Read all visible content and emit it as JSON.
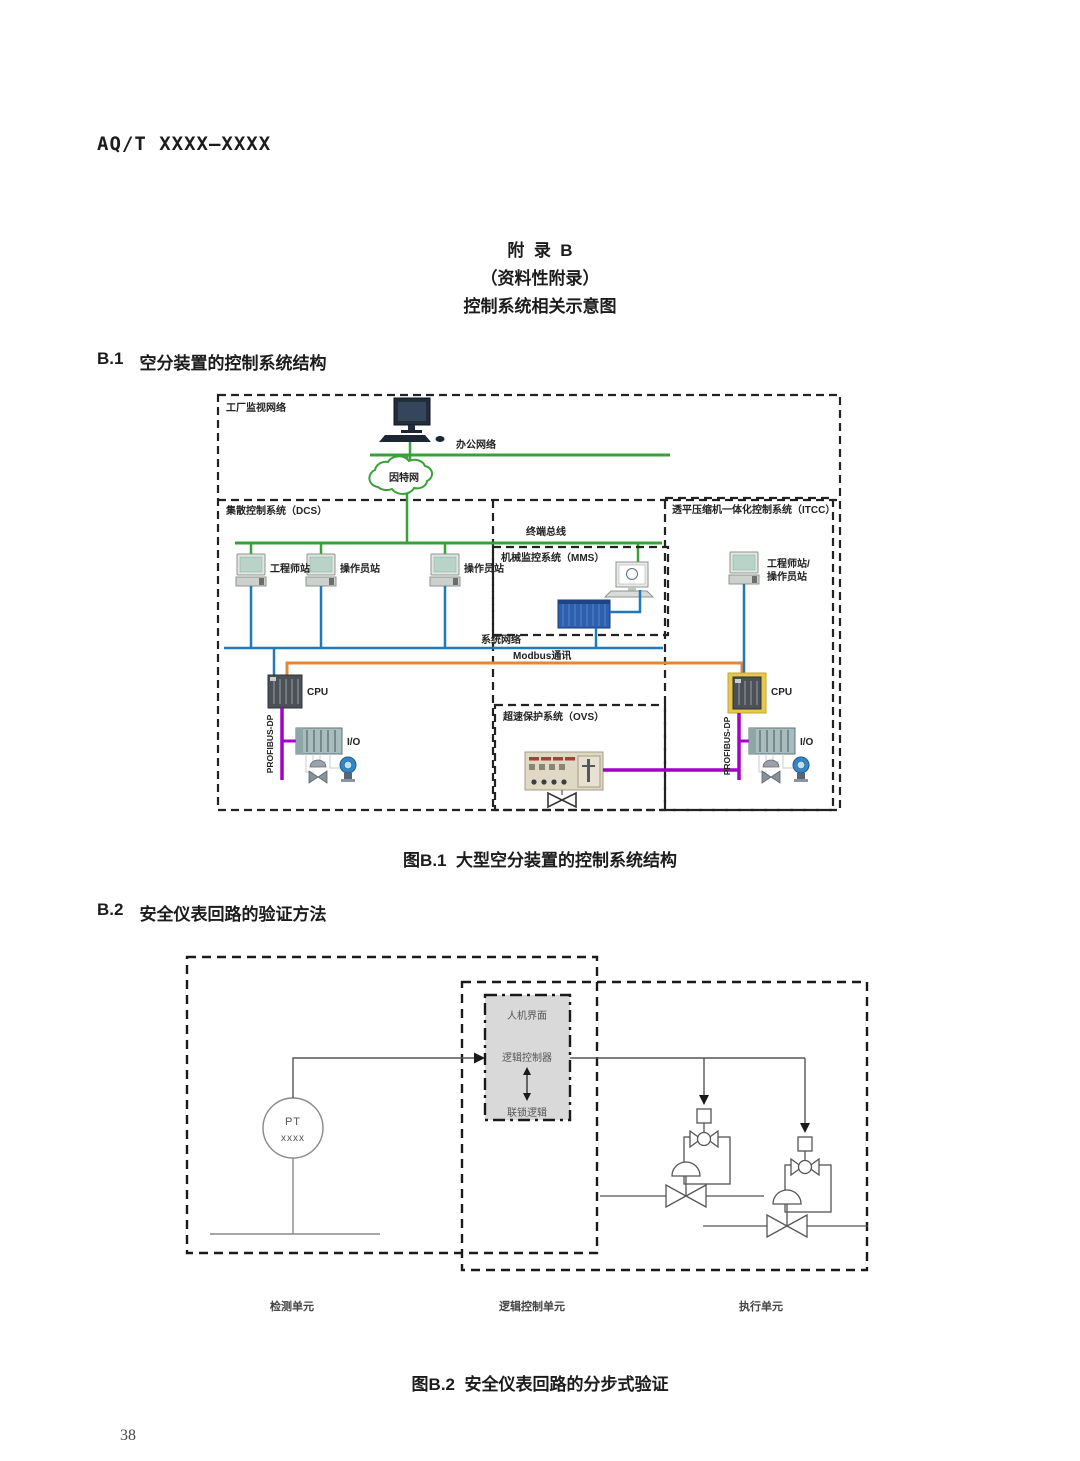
{
  "page": {
    "header": "AQ/T XXXX—XXXX",
    "number": "38"
  },
  "appendix": {
    "label": "附  录  B",
    "type": "（资料性附录）",
    "subject": "控制系统相关示意图"
  },
  "sections": {
    "b1": {
      "no": "B.1",
      "title": "空分装置的控制系统结构",
      "caption": "图B.1  大型空分装置的控制系统结构"
    },
    "b2": {
      "no": "B.2",
      "title": "安全仪表回路的验证方法",
      "caption": "图B.2  安全仪表回路的分步式验证"
    }
  },
  "fig_b1": {
    "plant_network": "工厂监视网络",
    "office_network": "办公网络",
    "internet": "因特网",
    "dcs": "集散控制系统（DCS）",
    "itcc": "透平压缩机一体化控制系统（ITCC）",
    "terminal_bus": "终端总线",
    "mms": "机械监控系统（MMS）",
    "ws_engineer": "工程师站",
    "ws_operator1": "操作员站",
    "ws_operator2": "操作员站",
    "itcc_ws_line1": "工程师站/",
    "itcc_ws_line2": "操作员站",
    "system_network": "系统网络",
    "modbus": "Modbus通讯",
    "cpu_left": "CPU",
    "cpu_right": "CPU",
    "profibus_left": "PROFIBUS-DP",
    "profibus_right": "PROFIBUS-DP",
    "io_left": "I/O",
    "io_right": "I/O",
    "ovs": "超速保护系统（OVS）",
    "colors": {
      "network_green": "#3aa13a",
      "system_blue": "#1f7ab5",
      "modbus_orange": "#e0873c",
      "profibus_purple": "#a300cb",
      "cpu_highlight_yellow": "#e8c84a"
    }
  },
  "fig_b2": {
    "hmi": "人机界面",
    "logic_controller": "逻辑控制器",
    "interlock_logic": "联锁逻辑",
    "pt_tag": "PT",
    "pt_value": "xxxx",
    "unit_detection": "检测单元",
    "unit_logic": "逻辑控制单元",
    "unit_execution": "执行单元"
  }
}
